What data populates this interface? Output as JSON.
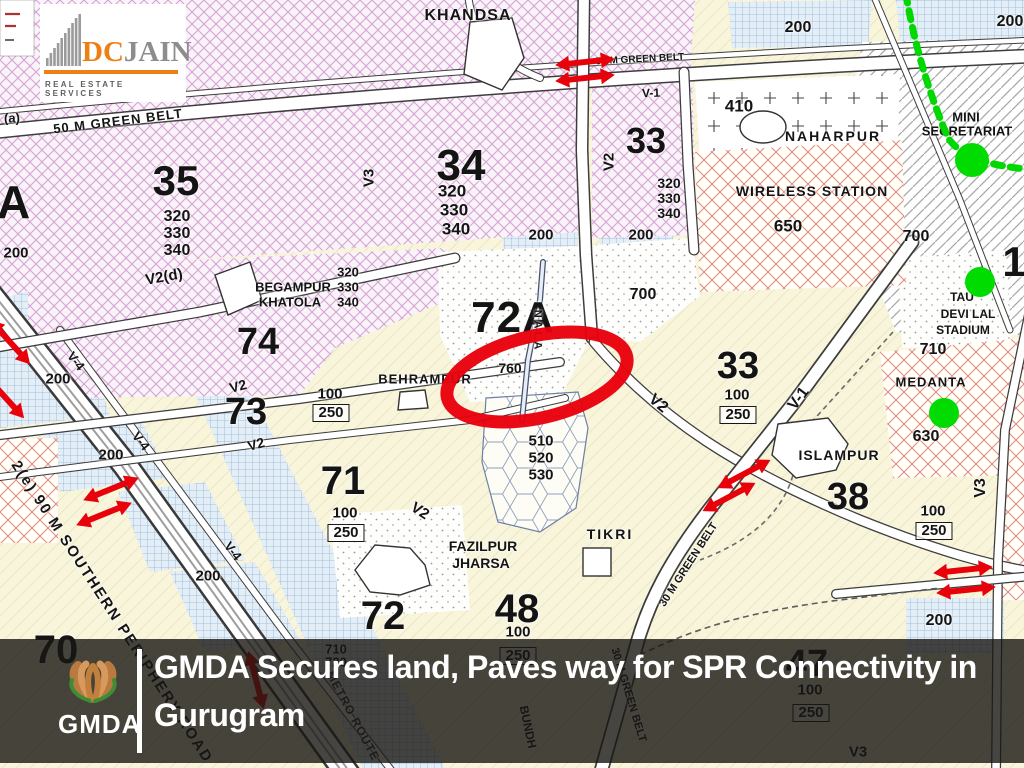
{
  "branding": {
    "dcjain": {
      "dc": "DC",
      "jain": "JAIN",
      "tagline": "REAL ESTATE SERVICES"
    },
    "gmda": {
      "name": "GMDA"
    }
  },
  "headline": {
    "line1": "GMDA Secures land, Paves way for SPR Connectivity in",
    "line2": "Gurugram"
  },
  "map": {
    "villages": {
      "khandsa": "KHANDSA",
      "naharpur": "NAHARPUR",
      "wireless_station": "WIRELESS STATION",
      "mini_line1": "MINI",
      "mini_line2": "SECRETARIAT",
      "tau_line1": "TAU",
      "tau_line2": "DEVI LAL",
      "tau_line3": "STADIUM",
      "medanta": "MEDANTA",
      "islampur": "ISLAMPUR",
      "begampur_line1": "BEGAMPUR",
      "begampur_line2": "KHATOLA",
      "behrampur": "BEHRAMPUR",
      "fazilpur_line1": "FAZILPUR",
      "fazilpur_line2": "JHARSA",
      "tikri": "TIKRI"
    },
    "sectors": {
      "s35": "35",
      "s34": "34",
      "s33": "33",
      "s74": "74",
      "s74a": "74A",
      "s72a": "72A",
      "s73": "73",
      "s71": "71",
      "s72": "72",
      "s48": "48",
      "s38": "38",
      "s70": "70",
      "s47": "47",
      "s1": "1"
    },
    "numbers": {
      "n100": "100",
      "n200": "200",
      "n250": "250",
      "n320": "320",
      "n330": "330",
      "n340": "340",
      "n410": "410",
      "n510": "510",
      "n520": "520",
      "n530": "530",
      "n630": "630",
      "n650": "650",
      "n700": "700",
      "n710": "710",
      "n720": "720",
      "n760": "760"
    },
    "roads": {
      "v1": "V-1",
      "v2": "V2",
      "v2d": "V2(d)",
      "v3": "V3",
      "v4": "V-4",
      "gb50": "50 M GREEN BELT",
      "gb30": "30 M GREEN BELT",
      "spr": "2(e) 90 M SOUTHERN PERIPHERY ROAD",
      "nala": "NALA",
      "bundh": "BUNDH",
      "metro": "METRO ROUTE",
      "a": "(a)"
    }
  },
  "colors": {
    "annotation_red": "#e8000b",
    "metro_green": "#00d800",
    "dcjain_orange": "#f07f13",
    "bar_bg": "rgba(25,23,19,0.8)"
  }
}
